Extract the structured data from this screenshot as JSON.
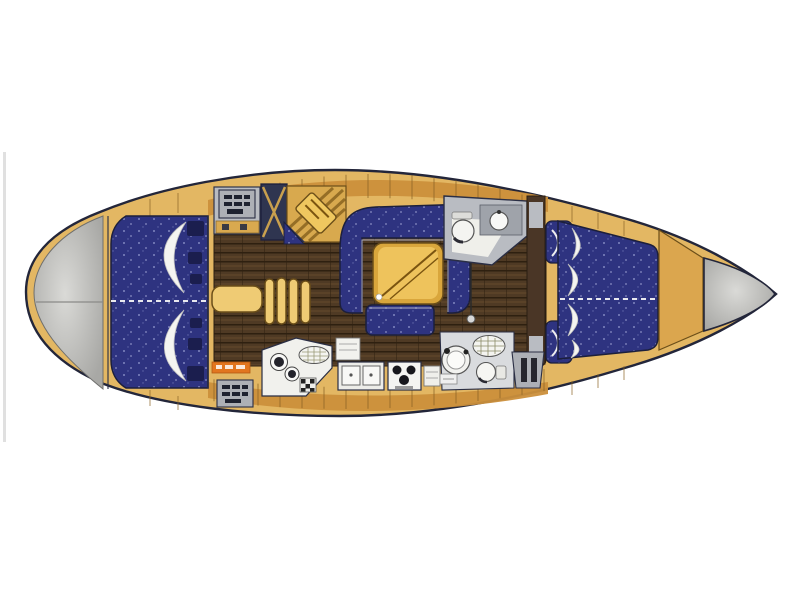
{
  "meta": {
    "title": "Sailing yacht interior layout plan, top view",
    "diagram_type": "boat-floorplan",
    "orientation": {
      "bow": "right",
      "stern": "left"
    }
  },
  "palette": {
    "background": "#ffffff",
    "deck": "#E3B763",
    "deck_band": "#CB8F3B",
    "deck_line": "#8A6426",
    "hull_outline": "#23263A",
    "upholstery_navy": "#2E3380",
    "upholstery_navy_dark": "#1B1E4E",
    "floor_wood": "#4F3A24",
    "stern_gray_edge": "#A8A8A5",
    "stern_gray_center": "#DADAD7",
    "fixture_white": "#F2F2EE",
    "fixture_gray": "#B9BCC2",
    "hatch_gray": "#ADB0B6",
    "table_gold": "#D9A63C",
    "table_highlight": "#EFC75F",
    "step_tan": "#EFCB74",
    "step_edge": "#6B4E19",
    "wardrobe_navy": "#2F3550",
    "wardrobe_lattice": "#C9A04E",
    "pillow_white": "#F4F4F1",
    "accent_orange_label": "#E2761F",
    "scan_artifact_gray": "#CFCFCF",
    "burner_black": "#17171C"
  },
  "parts": [
    {
      "name": "hull",
      "label": "hull outline"
    },
    {
      "name": "stern-platform",
      "label": "rounded stern / swim platform (gray)"
    },
    {
      "name": "aft-cabin-port-berth",
      "label": "aft double berth, port side"
    },
    {
      "name": "aft-cabin-starboard-berth",
      "label": "aft double berth, starboard side"
    },
    {
      "name": "deck-hatch",
      "label": "deck hatch with vent grid"
    },
    {
      "name": "aft-head-vanity",
      "label": "aft washroom vanity unit"
    },
    {
      "name": "wardrobe-locker",
      "label": "hanging locker with lattice door"
    },
    {
      "name": "nav-station",
      "label": "angled chart table with seat"
    },
    {
      "name": "companionway-steps",
      "label": "companionway steps"
    },
    {
      "name": "salon-settee",
      "label": "U-shaped salon settee"
    },
    {
      "name": "salon-bench",
      "label": "straight salon bench"
    },
    {
      "name": "salon-table",
      "label": "folding salon table"
    },
    {
      "name": "galley-round-sinks",
      "label": "galley corner unit with twin round sinks"
    },
    {
      "name": "galley-double-sink",
      "label": "double square sink"
    },
    {
      "name": "galley-stove",
      "label": "three-burner stove"
    },
    {
      "name": "forward-head",
      "label": "forward washroom with toilet and basin"
    },
    {
      "name": "aft-head",
      "label": "aft washroom with basin, toilet and shower grate"
    },
    {
      "name": "forward-cabin-berth",
      "label": "forward V-berth"
    },
    {
      "name": "forward-cabin-seat",
      "label": "forward cabin corner seat"
    },
    {
      "name": "foredeck",
      "label": "foredeck / anchor locker"
    },
    {
      "name": "bow-tip",
      "label": "pointed bow (gray)"
    },
    {
      "name": "brand-label-strip",
      "label": "small orange builder label (illegible)"
    }
  ]
}
